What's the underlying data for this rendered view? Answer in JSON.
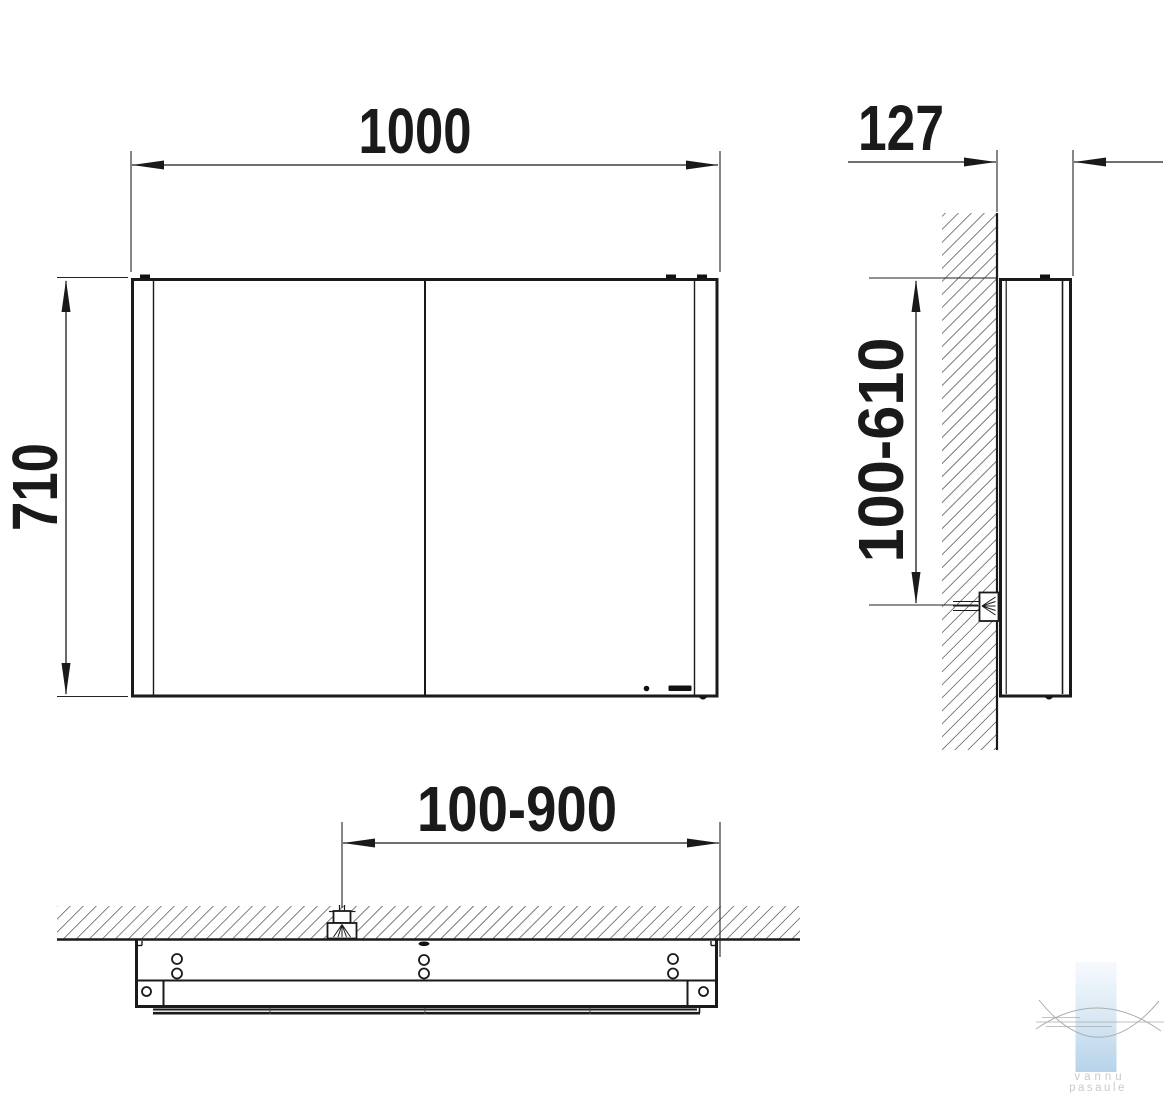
{
  "drawing_labels": {
    "front_width": "1000",
    "front_height": "710",
    "side_depth": "127",
    "side_mount_height_range": "100-610",
    "bottom_mount_width_range": "100-900"
  },
  "watermark": {
    "line1": "vannu",
    "line2": "pasaule"
  },
  "colors": {
    "line": "#1a1a1a",
    "hatch": "#2a2a2a",
    "watermark_top": "#f7fafd",
    "watermark_mid": "#dceaf5",
    "watermark_bottom": "#b7d3e9",
    "watermark_arc": "#a9aeb2",
    "watermark_text": "#c6cbd0"
  }
}
